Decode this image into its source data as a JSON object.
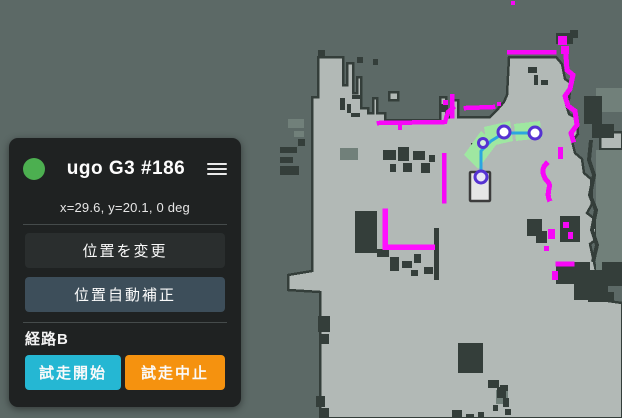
{
  "robot_panel": {
    "title": "ugo G3 #186",
    "status_icon": "online-status-dot",
    "status_color": "#4caf50",
    "menu_icon": "hamburger-menu",
    "pose_text": "x=29.6, y=20.1, 0 deg",
    "actions": {
      "change_position_label": "位置を変更",
      "auto_position_correct_label": "位置自動補正"
    },
    "route": {
      "label": "経路B",
      "start_label": "試走開始",
      "abort_label": "試走中止"
    },
    "colors": {
      "panel_bg": "#1f2222",
      "button_dark": "#2a2e2e",
      "button_slate": "#3d4e5a",
      "button_cyan": "#25b7d3",
      "button_orange": "#f5920f"
    }
  },
  "map": {
    "description": "occupancy-grid-map-with-lidar-scan-and-trial-route",
    "colors": {
      "unknown": "#5c6966",
      "free": "#b2b9b6",
      "obstacle": "#343e3a",
      "shadow": "#71807a",
      "scan": "#f707f7",
      "scan_bright": "#ff10ff",
      "route_zone": "#9fe7a1",
      "route_path": "#2ba6e0",
      "waypoint_ring": "#5632d2",
      "robot_fill": "#e6e6e6",
      "robot_border": "#3c3c3c"
    },
    "robot": {
      "x": 470,
      "y": 172,
      "width": 20,
      "height": 29
    },
    "waypoints": [
      {
        "x": 481,
        "y": 177,
        "r": 6,
        "fill": "#e9e6f5"
      },
      {
        "x": 483,
        "y": 143,
        "r": 4.5,
        "fill": "#d9f0dc"
      },
      {
        "x": 504,
        "y": 132,
        "r": 6,
        "fill": "#ffffff"
      },
      {
        "x": 535,
        "y": 133,
        "r": 6,
        "fill": "#ffffff"
      }
    ]
  }
}
